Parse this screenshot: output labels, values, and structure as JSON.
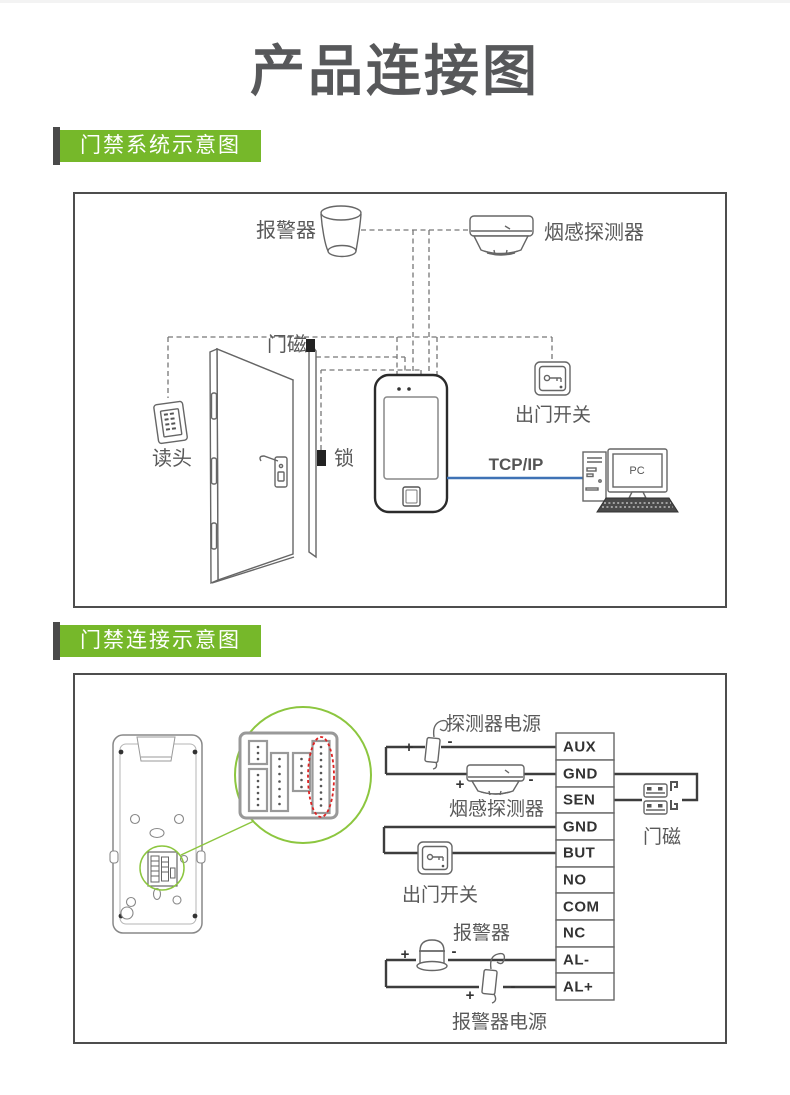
{
  "page": {
    "title": "产品连接图"
  },
  "colors": {
    "accent_green": "#76b82a",
    "detail_green": "#8cc63f",
    "tcp_blue": "#3f72b5",
    "red_dashed": "#dd2222",
    "title_gray": "#57585a",
    "wire_gray": "#3d3d3d"
  },
  "section1": {
    "header": "门禁系统示意图",
    "labels": {
      "alarm": "报警器",
      "smoke_detector": "烟感探测器",
      "door_magnet": "门磁",
      "reader": "读头",
      "lock": "锁",
      "exit_switch": "出门开关",
      "network": "TCP/IP",
      "pc": "PC"
    }
  },
  "section2": {
    "header": "门禁连接示意图",
    "labels": {
      "detector_power": "探测器电源",
      "smoke_detector": "烟感探测器",
      "exit_switch": "出门开关",
      "alarm": "报警器",
      "alarm_power": "报警器电源",
      "door_magnet": "门磁",
      "plus": "+",
      "minus": "-"
    },
    "terminals": [
      "AUX",
      "GND",
      "SEN",
      "GND",
      "BUT",
      "NO",
      "COM",
      "NC",
      "AL-",
      "AL+"
    ]
  }
}
